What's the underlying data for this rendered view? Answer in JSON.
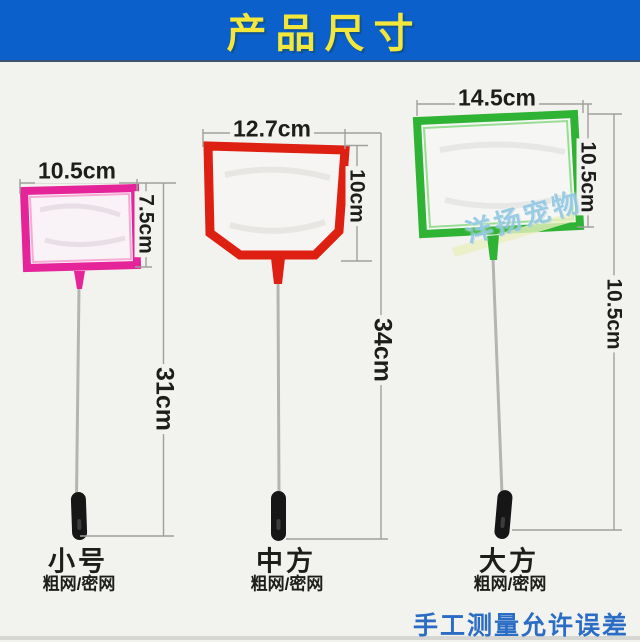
{
  "banner": {
    "title": "产品尺寸"
  },
  "colors": {
    "banner_bg": "#0b60cc",
    "banner_text": "#f2e73a",
    "small_frame": "#e5249a",
    "medium_frame": "#dd2012",
    "large_frame": "#2fb335",
    "dim_line": "#9f9f9b",
    "footer_text": "#2b6cc4",
    "watermark_text": "#7dbedc"
  },
  "products": [
    {
      "name": "小号",
      "mesh_note": "粗网/密网",
      "width": "10.5cm",
      "depth": "7.5cm",
      "length": "31cm"
    },
    {
      "name": "中方",
      "mesh_note": "粗网/密网",
      "width": "12.7cm",
      "depth": "10cm",
      "length": "34cm"
    },
    {
      "name": "大方",
      "mesh_note": "粗网/密网",
      "width": "14.5cm",
      "depth": "10.5cm",
      "length": "10.5cm"
    }
  ],
  "watermark": "洋扬宠物",
  "footer_note": "手工测量允许误差"
}
